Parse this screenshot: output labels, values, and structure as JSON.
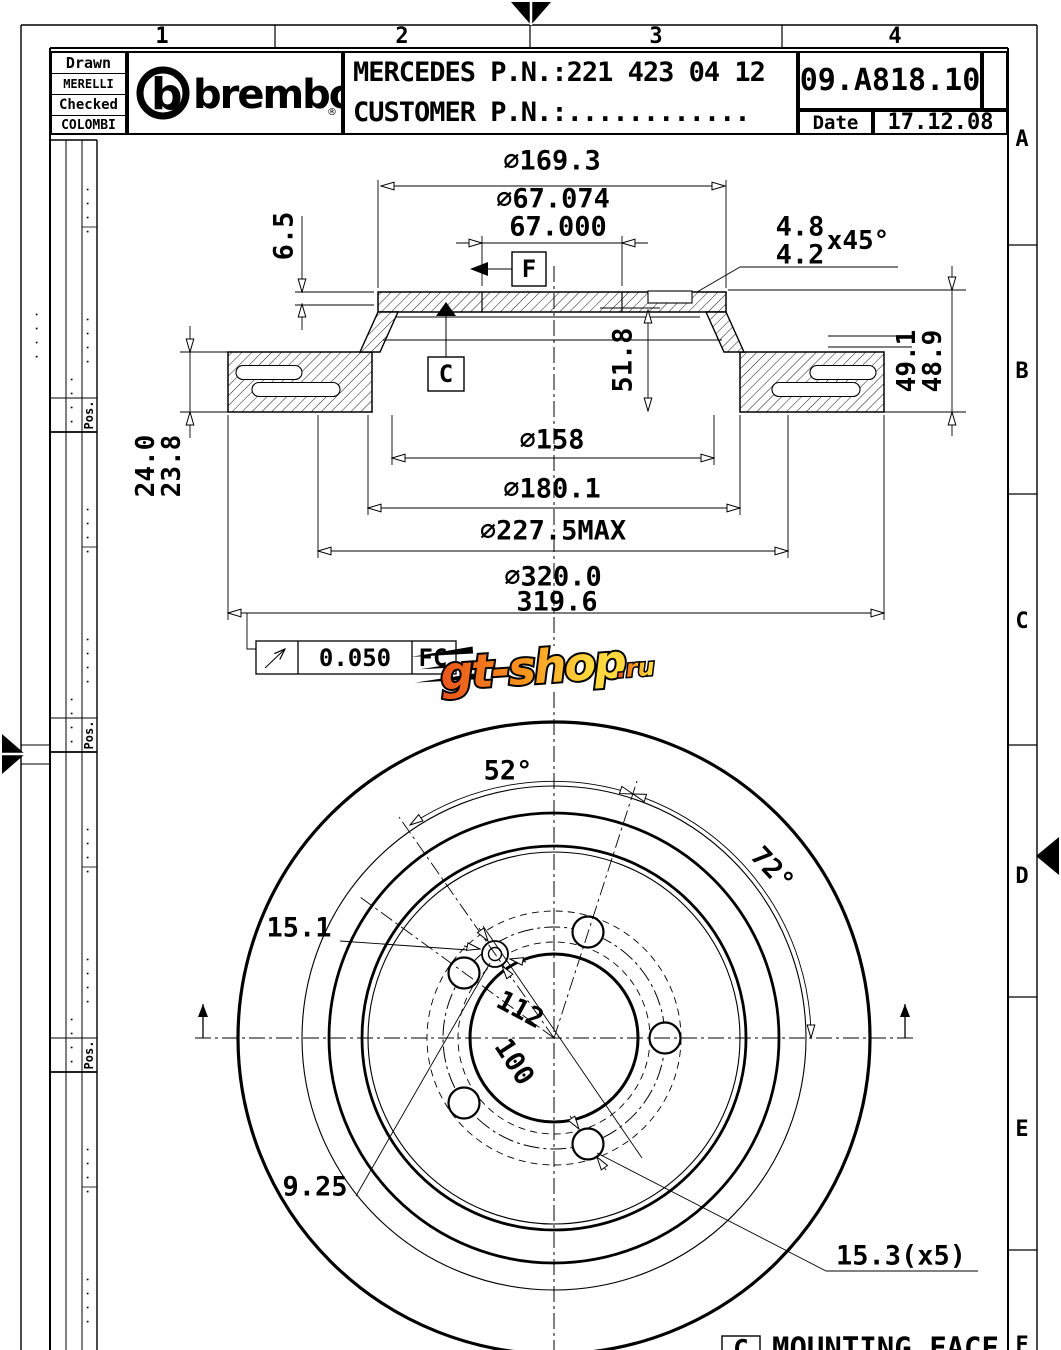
{
  "title_block": {
    "drawn_label": "Drawn",
    "drawn_value": "MERELLI ST.",
    "checked_label": "Checked",
    "checked_value": "COLOMBI",
    "logo_b": "b",
    "brand": "brembo",
    "registered": "®",
    "customer_line1": "MERCEDES P.N.:221 423 04 12",
    "customer_line2": "CUSTOMER P.N.:............",
    "part_number": "09.A818.10",
    "date_label": "Date",
    "date_value": "17.12.08"
  },
  "frame": {
    "columns": [
      "1",
      "2",
      "3",
      "4"
    ],
    "rows": [
      "A",
      "B",
      "C",
      "D",
      "E",
      "F"
    ],
    "pos_label": "Pos.",
    "dots": "· · · ·"
  },
  "section": {
    "dia_outer_flange": "∅169.3",
    "bore_max": "∅67.074",
    "bore_min": "67.000",
    "flange_thickness": "6.5",
    "chamfer_max": "4.8",
    "chamfer_min": "4.2",
    "chamfer_angle": "x45°",
    "height_inner": "51.8",
    "height_max": "49.1",
    "height_min": "48.9",
    "disc_thickness_max": "24.0",
    "disc_thickness_min": "23.8",
    "dia_158": "∅158",
    "dia_180": "∅180.1",
    "dia_227": "∅227.5MAX",
    "dia_outer_max": "∅320.0",
    "dia_outer_min": "319.6",
    "datum_f": "F",
    "datum_c": "C",
    "runout_value": "0.050",
    "runout_datum": "FC"
  },
  "front": {
    "angle_pin": "52°",
    "angle_holes": "72°",
    "pin_hole_dia": "15.1",
    "bolt_circle": "112",
    "dia_100": "100",
    "pin_dia": "9.25",
    "bolt_hole_dia": "15.3(x5)",
    "note_datum": "C",
    "note_text": "MOUNTING FACE"
  },
  "watermark": {
    "text_main": "gt-shop",
    "text_suffix": ".ru",
    "color_start": "#e8541d",
    "color_mid": "#f7941d",
    "color_end": "#ffd73e"
  }
}
